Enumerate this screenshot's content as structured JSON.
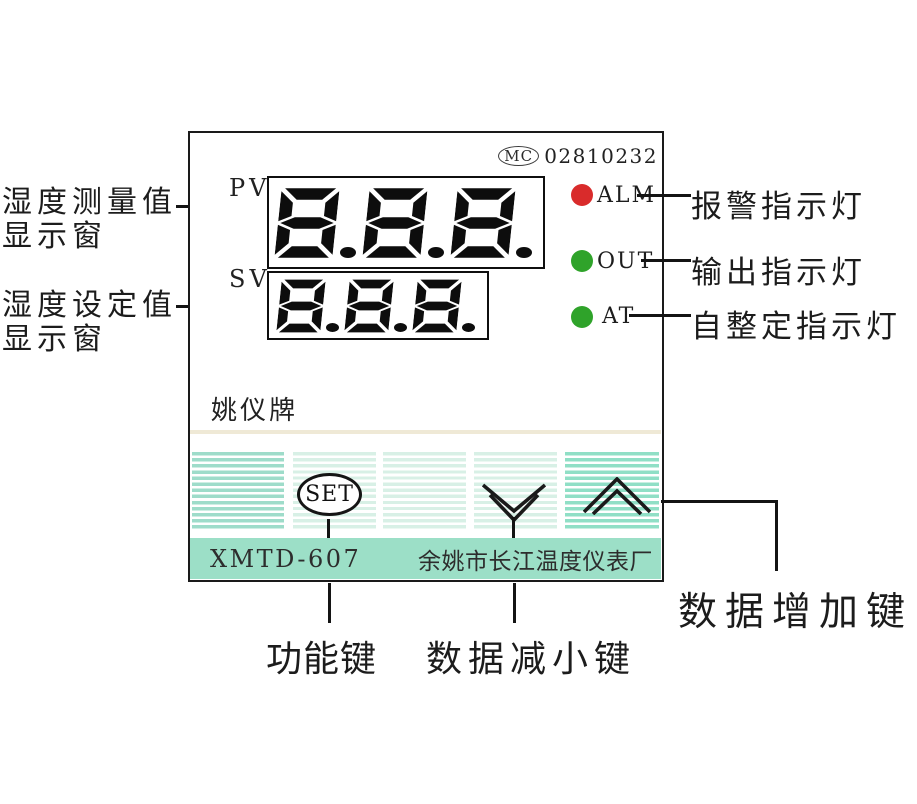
{
  "device": {
    "certification": {
      "logo": "MC",
      "number": "02810232"
    },
    "pv_label": "PV",
    "sv_label": "SV",
    "pv_value": "8.8.8.",
    "sv_value": "8.8.8.",
    "indicators": [
      {
        "label": "ALM",
        "color": "#d92b2b"
      },
      {
        "label": "OUT",
        "color": "#2fa32a"
      },
      {
        "label": "AT",
        "color": "#2fa32a"
      }
    ],
    "brand": "姚仪牌",
    "set_button_label": "SET",
    "model": "XMTD-607",
    "manufacturer": "余姚市长江温度仪表厂"
  },
  "annotations": {
    "pv_window_line1": "湿度测量值",
    "pv_window_line2": "显示窗",
    "sv_window_line1": "湿度设定值",
    "sv_window_line2": "显示窗",
    "alarm_light": "报警指示灯",
    "output_light": "输出指示灯",
    "autotune_light": "自整定指示灯",
    "function_key": "功能键",
    "decrease_key": "数据减小键",
    "increase_key": "数据增加键"
  },
  "colors": {
    "teal_bar": "#9cdfc7",
    "key_stripe_dark": "#9edcca",
    "key_stripe_light": "#d8f0e6",
    "key_stripe_medium": "#90dfc6",
    "cream_separator": "#efe9d6",
    "alarm_red": "#d92b2b",
    "indicator_green": "#2fa32a"
  }
}
